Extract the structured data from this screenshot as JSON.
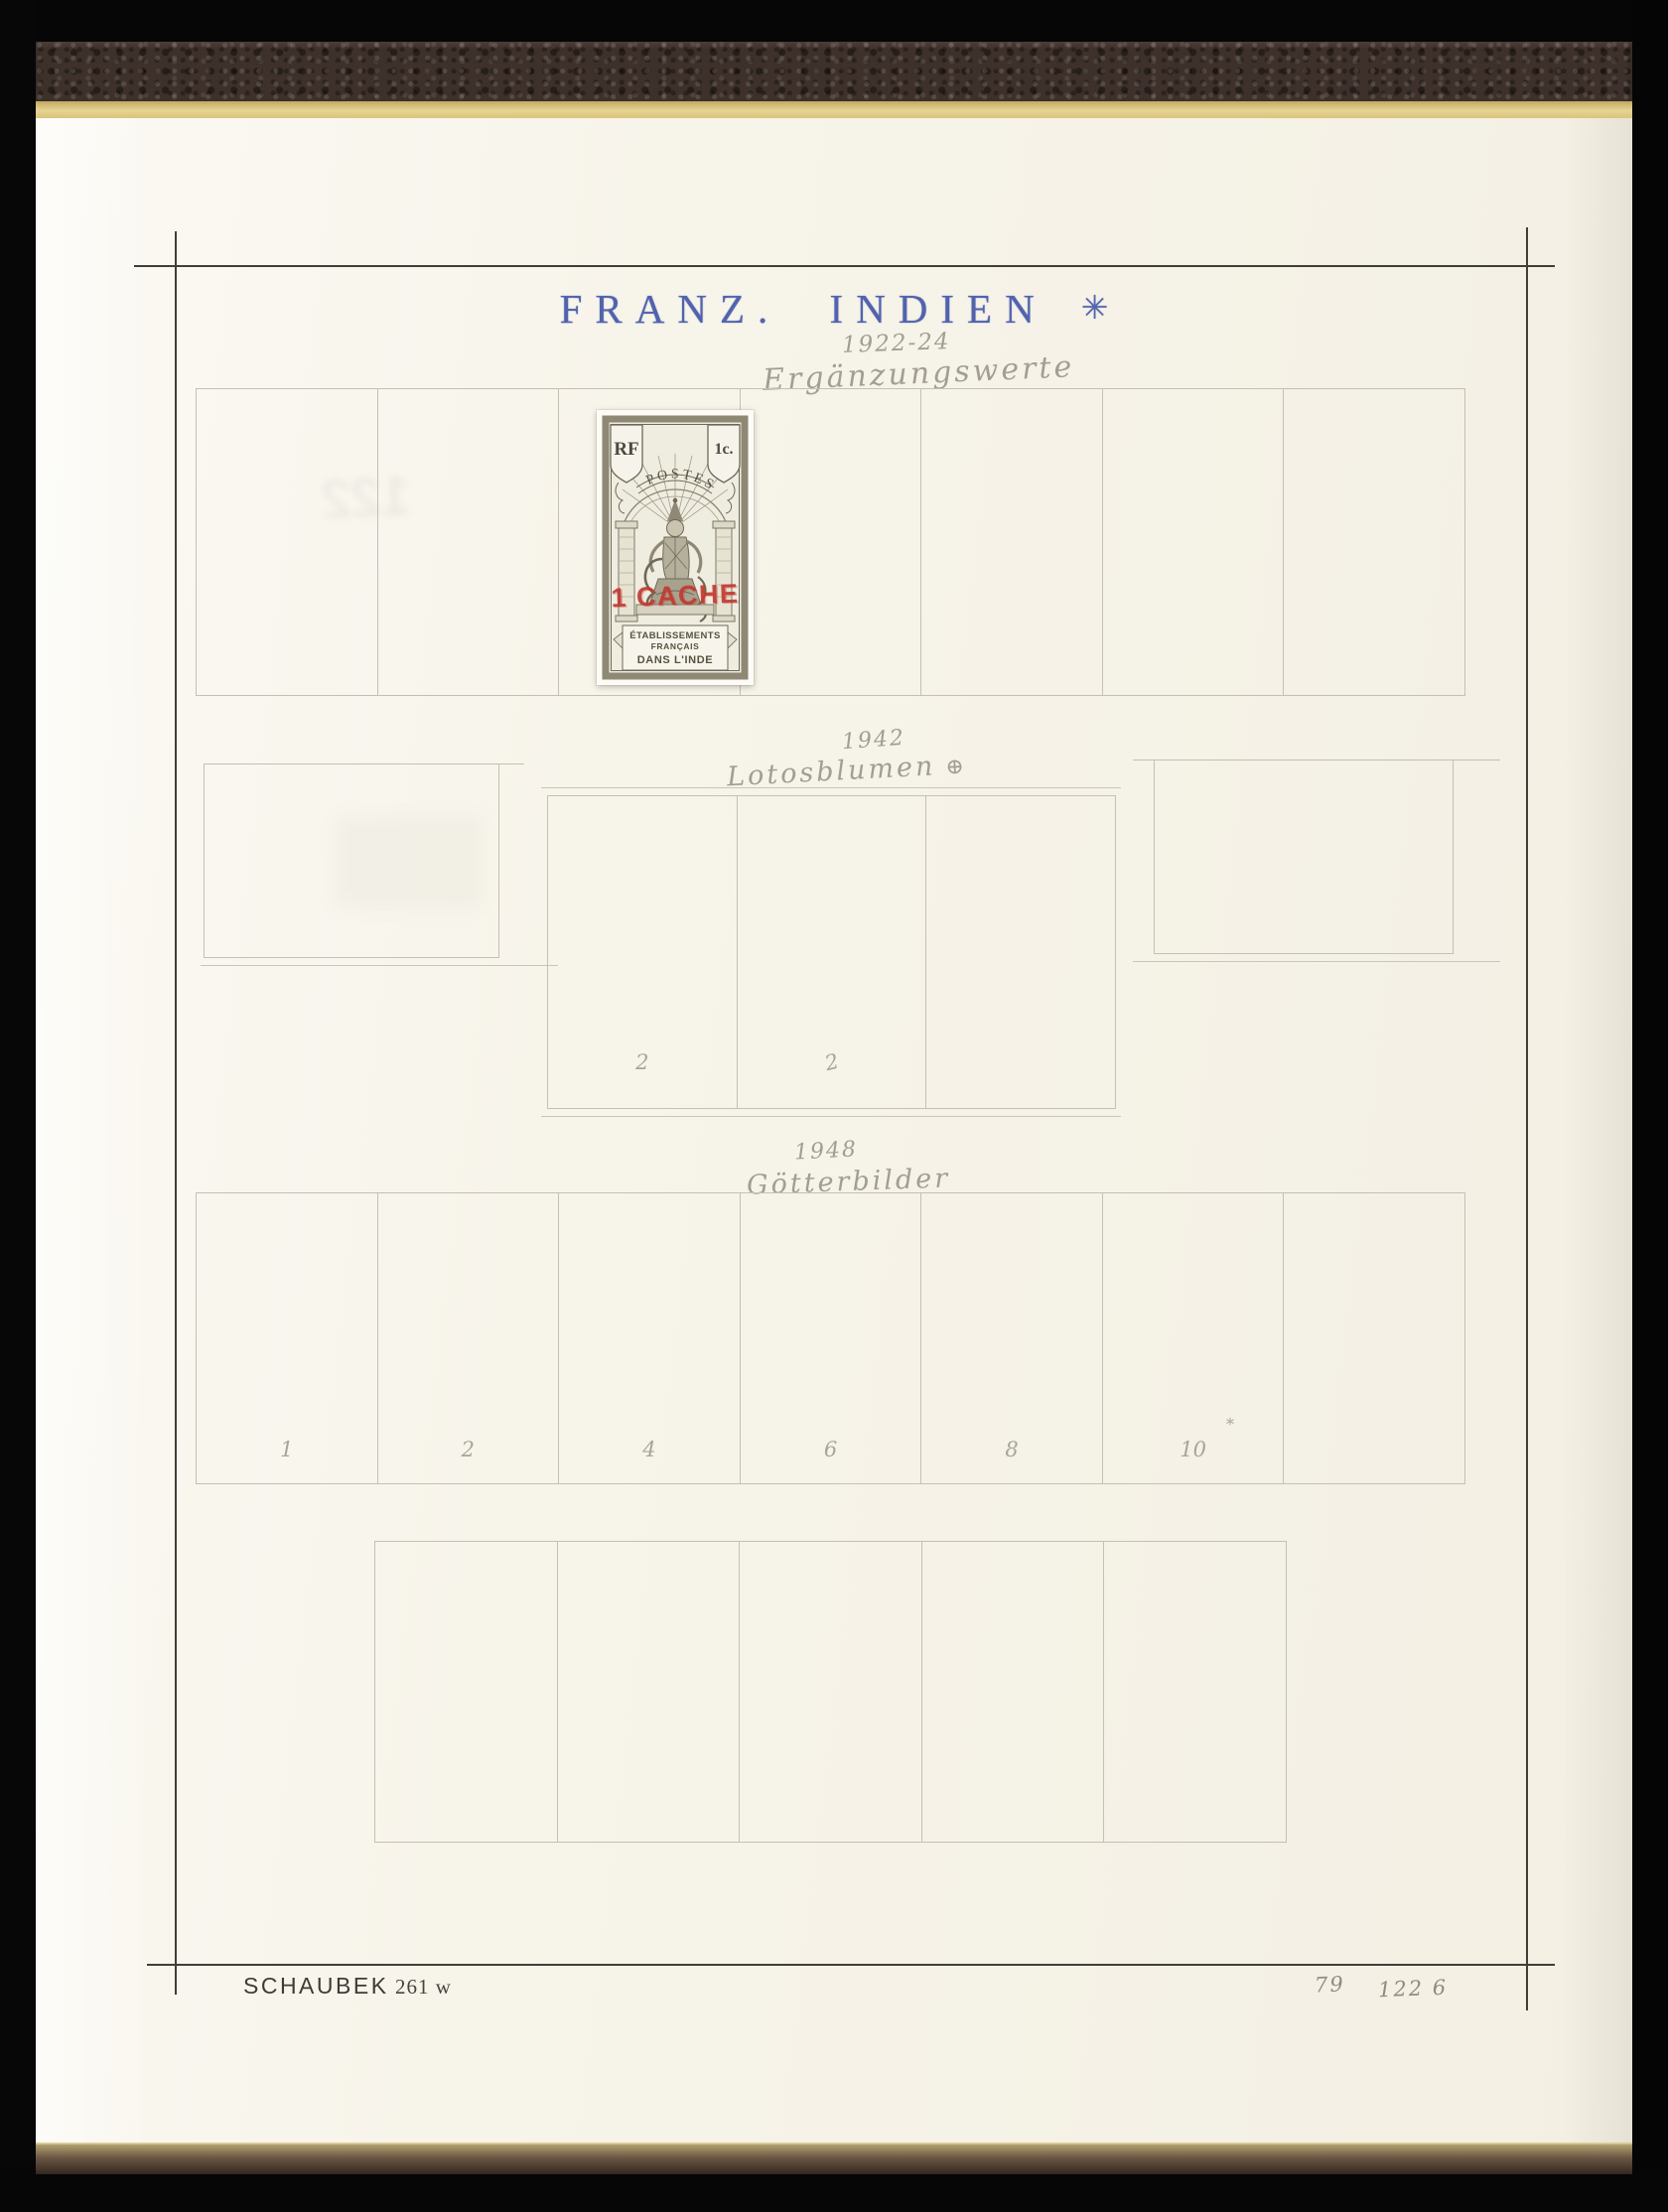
{
  "header": {
    "title": "FRANZ. INDIEN",
    "star": "✳"
  },
  "annot": {
    "s1_year": "1922-24",
    "s1_label": "Ergänzungswerte",
    "s2_year": "1942",
    "s2_label": "Lotosblumen",
    "s2_symbol": "⊕",
    "s2_n1": "2",
    "s2_n2": "2",
    "s3_year": "1948",
    "s3_label": "Götterbilder",
    "s3_n1": "1",
    "s3_n2": "2",
    "s3_n3": "4",
    "s3_n4": "6",
    "s3_n5": "8",
    "s3_n6": "10",
    "s3_star": "*",
    "pg_left": "79",
    "pg_right": "122 6"
  },
  "footer": {
    "publisher": "SCHAUBEK",
    "plate": "261 w"
  },
  "stamp": {
    "banner": "POSTES",
    "shield_left": "RF",
    "shield_right": "1c.",
    "overprint": "1 CACHE",
    "caption_line1": "ÉTABLISSEMENTS",
    "caption_line2": "FRANÇAIS",
    "caption_line3": "DANS L'INDE"
  },
  "colors": {
    "title_blue": "#5163ad",
    "overprint_red": "#c13a30",
    "leather_brown": "#3e302a",
    "page_cream": "#f6f3ea",
    "edge_yellow": "#e7d492",
    "pencil_gray": "#a29e91"
  }
}
